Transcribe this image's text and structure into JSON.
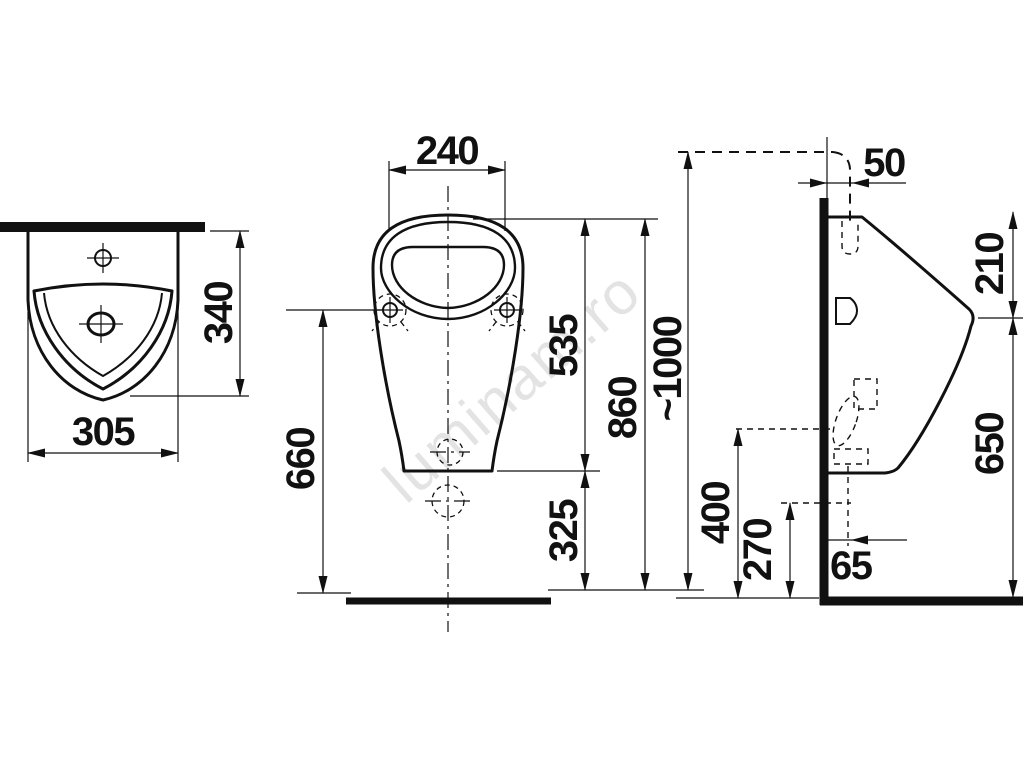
{
  "watermark": "luminam.ro",
  "colors": {
    "ink": "#111111",
    "watermark": "#e3e3e3",
    "background": "#ffffff"
  },
  "views": {
    "top": {
      "width_mm": "305",
      "depth_mm": "340"
    },
    "front": {
      "rim_width_mm": "240",
      "rim_to_body_bottom_mm": "535",
      "rim_height_mm": "860",
      "fixing_holes_height_mm": "660",
      "body_bottom_height_mm": "325"
    },
    "side": {
      "inlet_wall_offset_mm": "50",
      "rim_to_spout_mm": "210",
      "inlet_height_mm": "~1000",
      "outlet_height_mm": "400",
      "drain_height_mm": "270",
      "drain_wall_offset_mm": "65",
      "spout_height_mm": "650"
    }
  }
}
